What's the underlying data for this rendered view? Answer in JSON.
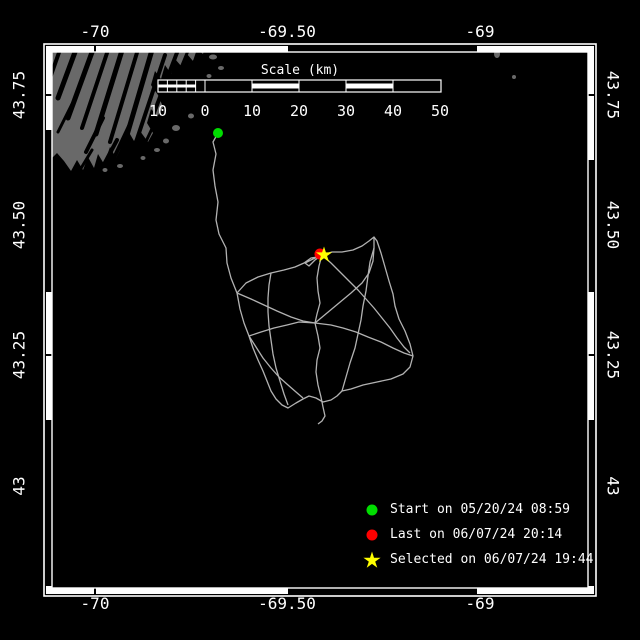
{
  "axes": {
    "top": [
      {
        "text": "-70"
      },
      {
        "text": "-69.50"
      },
      {
        "text": "-69"
      }
    ],
    "bottom": [
      {
        "text": "-70"
      },
      {
        "text": "-69.50"
      },
      {
        "text": "-69"
      }
    ],
    "left": [
      {
        "text": "43.75"
      },
      {
        "text": "43.50"
      },
      {
        "text": "43.25"
      },
      {
        "text": "43"
      }
    ],
    "right": [
      {
        "text": "43.75"
      },
      {
        "text": "43.50"
      },
      {
        "text": "43.25"
      },
      {
        "text": "43"
      }
    ]
  },
  "scale_bar": {
    "title": "Scale (km)",
    "tick_labels": [
      "10",
      "0",
      "10",
      "20",
      "30",
      "40",
      "50"
    ]
  },
  "legend": {
    "items": [
      {
        "marker": "circle",
        "color": "#00dd00",
        "label": "Start on 05/20/24 08:59"
      },
      {
        "marker": "circle",
        "color": "#ff0000",
        "label": "Last on 06/07/24 20:14"
      },
      {
        "marker": "star",
        "color": "#ffff00",
        "label": "Selected on 06/07/24 19:44"
      }
    ]
  },
  "map": {
    "background_color": "#000000",
    "land_color": "#696969",
    "track_color": "#b2b2b2",
    "frame_color": "#ffffff",
    "land_polygon": [
      [
        46,
        44
      ],
      [
        206,
        44
      ],
      [
        203,
        54
      ],
      [
        197,
        49
      ],
      [
        193,
        61
      ],
      [
        187,
        54
      ],
      [
        182,
        67
      ],
      [
        175,
        59
      ],
      [
        171,
        74
      ],
      [
        165,
        65
      ],
      [
        161,
        79
      ],
      [
        155,
        71
      ],
      [
        151,
        85
      ],
      [
        158,
        95
      ],
      [
        163,
        107
      ],
      [
        157,
        117
      ],
      [
        151,
        109
      ],
      [
        147,
        123
      ],
      [
        153,
        133
      ],
      [
        148,
        142
      ],
      [
        140,
        131
      ],
      [
        134,
        141
      ],
      [
        127,
        129
      ],
      [
        122,
        146
      ],
      [
        116,
        158
      ],
      [
        110,
        147
      ],
      [
        104,
        164
      ],
      [
        98,
        154
      ],
      [
        94,
        168
      ],
      [
        88,
        157
      ],
      [
        83,
        170
      ],
      [
        77,
        160
      ],
      [
        71,
        171
      ],
      [
        64,
        161
      ],
      [
        57,
        153
      ],
      [
        51,
        159
      ],
      [
        46,
        156
      ]
    ],
    "fjords": [
      [
        62,
        44,
        50,
        78,
        4
      ],
      [
        78,
        44,
        58,
        98,
        5
      ],
      [
        95,
        44,
        68,
        118,
        5
      ],
      [
        110,
        44,
        82,
        128,
        4
      ],
      [
        124,
        44,
        96,
        134,
        5
      ],
      [
        139,
        46,
        110,
        142,
        4
      ],
      [
        152,
        50,
        122,
        152,
        5
      ],
      [
        165,
        55,
        134,
        148,
        4
      ],
      [
        178,
        50,
        152,
        118,
        4
      ],
      [
        190,
        46,
        166,
        104,
        3
      ],
      [
        200,
        50,
        180,
        90,
        3
      ],
      [
        72,
        104,
        58,
        132,
        3
      ],
      [
        103,
        118,
        86,
        152,
        4
      ],
      [
        131,
        122,
        114,
        158,
        4
      ],
      [
        157,
        118,
        142,
        150,
        3
      ],
      [
        186,
        78,
        172,
        100,
        3
      ],
      [
        117,
        140,
        100,
        172,
        4
      ],
      [
        92,
        150,
        80,
        170,
        3
      ]
    ],
    "islands": [
      [
        213,
        57,
        4,
        2.5
      ],
      [
        221,
        68,
        3,
        2
      ],
      [
        209,
        76,
        2.5,
        2
      ],
      [
        497,
        54,
        3,
        4
      ],
      [
        514,
        77,
        2,
        2
      ],
      [
        176,
        128,
        4,
        3
      ],
      [
        166,
        141,
        3,
        2.5
      ],
      [
        191,
        116,
        3,
        2.5
      ],
      [
        157,
        150,
        3,
        2
      ],
      [
        143,
        158,
        2.5,
        2
      ],
      [
        120,
        166,
        3,
        2
      ],
      [
        105,
        170,
        2.5,
        2
      ]
    ],
    "track_polylines": [
      [
        [
          218,
          133
        ],
        [
          213,
          142
        ],
        [
          216,
          154
        ],
        [
          213,
          170
        ],
        [
          215,
          186
        ],
        [
          218,
          202
        ],
        [
          216,
          220
        ],
        [
          219,
          234
        ],
        [
          226,
          248
        ],
        [
          227,
          263
        ],
        [
          231,
          278
        ],
        [
          237,
          293
        ]
      ],
      [
        [
          237,
          293
        ],
        [
          246,
          283
        ],
        [
          258,
          277
        ],
        [
          271,
          273
        ],
        [
          284,
          270
        ],
        [
          295,
          267
        ],
        [
          304,
          263
        ],
        [
          311,
          258
        ],
        [
          317,
          257
        ],
        [
          305,
          263
        ],
        [
          309,
          266
        ],
        [
          315,
          260
        ],
        [
          322,
          255
        ]
      ],
      [
        [
          322,
          255
        ],
        [
          332,
          252
        ],
        [
          342,
          252
        ],
        [
          353,
          250
        ],
        [
          362,
          246
        ],
        [
          369,
          241
        ],
        [
          374,
          237
        ],
        [
          377,
          241
        ],
        [
          381,
          253
        ],
        [
          385,
          267
        ],
        [
          389,
          281
        ],
        [
          393,
          294
        ],
        [
          395,
          306
        ],
        [
          399,
          319
        ],
        [
          405,
          331
        ],
        [
          410,
          344
        ],
        [
          413,
          356
        ],
        [
          410,
          367
        ],
        [
          403,
          374
        ],
        [
          391,
          379
        ],
        [
          377,
          382
        ],
        [
          363,
          385
        ],
        [
          351,
          389
        ],
        [
          342,
          391
        ]
      ],
      [
        [
          237,
          293
        ],
        [
          240,
          309
        ],
        [
          244,
          323
        ],
        [
          249,
          336
        ],
        [
          253,
          348
        ],
        [
          258,
          360
        ],
        [
          263,
          371
        ],
        [
          267,
          381
        ],
        [
          271,
          391
        ],
        [
          276,
          399
        ],
        [
          282,
          405
        ],
        [
          288,
          408
        ],
        [
          296,
          403
        ],
        [
          303,
          399
        ],
        [
          309,
          396
        ],
        [
          316,
          398
        ],
        [
          323,
          402
        ],
        [
          331,
          400
        ],
        [
          337,
          396
        ],
        [
          342,
          391
        ]
      ],
      [
        [
          322,
          255
        ],
        [
          319,
          266
        ],
        [
          317,
          278
        ],
        [
          318,
          291
        ],
        [
          320,
          303
        ],
        [
          317,
          314
        ],
        [
          315,
          323
        ],
        [
          318,
          336
        ],
        [
          320,
          348
        ],
        [
          317,
          360
        ],
        [
          316,
          372
        ],
        [
          318,
          385
        ],
        [
          321,
          397
        ],
        [
          323,
          407
        ],
        [
          325,
          416
        ],
        [
          322,
          421
        ],
        [
          318,
          424
        ]
      ],
      [
        [
          249,
          336
        ],
        [
          261,
          332
        ],
        [
          274,
          328
        ],
        [
          287,
          325
        ],
        [
          299,
          322
        ],
        [
          315,
          323
        ],
        [
          331,
          325
        ],
        [
          343,
          328
        ],
        [
          356,
          332
        ],
        [
          368,
          337
        ],
        [
          381,
          342
        ],
        [
          393,
          348
        ],
        [
          404,
          353
        ],
        [
          413,
          356
        ]
      ],
      [
        [
          237,
          293
        ],
        [
          251,
          299
        ],
        [
          264,
          305
        ],
        [
          277,
          311
        ],
        [
          291,
          317
        ],
        [
          303,
          321
        ],
        [
          315,
          323
        ]
      ],
      [
        [
          315,
          323
        ],
        [
          327,
          313
        ],
        [
          339,
          303
        ],
        [
          351,
          293
        ],
        [
          362,
          283
        ],
        [
          369,
          273
        ],
        [
          373,
          261
        ],
        [
          374,
          248
        ],
        [
          374,
          237
        ]
      ],
      [
        [
          374,
          248
        ],
        [
          370,
          262
        ],
        [
          368,
          276
        ],
        [
          366,
          291
        ],
        [
          363,
          306
        ],
        [
          361,
          320
        ],
        [
          358,
          334
        ],
        [
          355,
          348
        ],
        [
          350,
          363
        ],
        [
          346,
          377
        ],
        [
          342,
          391
        ]
      ],
      [
        [
          322,
          255
        ],
        [
          331,
          263
        ],
        [
          340,
          272
        ],
        [
          349,
          281
        ],
        [
          358,
          290
        ],
        [
          366,
          299
        ],
        [
          374,
          308
        ],
        [
          382,
          318
        ],
        [
          390,
          328
        ],
        [
          397,
          338
        ],
        [
          404,
          347
        ],
        [
          410,
          353
        ]
      ],
      [
        [
          249,
          336
        ],
        [
          256,
          347
        ],
        [
          263,
          358
        ],
        [
          271,
          368
        ],
        [
          279,
          377
        ],
        [
          288,
          385
        ],
        [
          296,
          392
        ],
        [
          303,
          398
        ]
      ],
      [
        [
          271,
          273
        ],
        [
          269,
          285
        ],
        [
          268,
          298
        ],
        [
          268,
          312
        ],
        [
          269,
          326
        ],
        [
          271,
          340
        ],
        [
          273,
          354
        ],
        [
          276,
          368
        ],
        [
          280,
          381
        ],
        [
          284,
          394
        ],
        [
          288,
          405
        ]
      ]
    ],
    "markers": {
      "start": {
        "x": 218,
        "y": 133,
        "r": 5,
        "shape": "circle",
        "color": "#00dd00"
      },
      "last": {
        "x": 320,
        "y": 254,
        "r": 5.5,
        "shape": "circle",
        "color": "#ff0000"
      },
      "selected": {
        "x": 324,
        "y": 255,
        "r": 8.5,
        "shape": "star",
        "color": "#ffff00"
      }
    }
  }
}
